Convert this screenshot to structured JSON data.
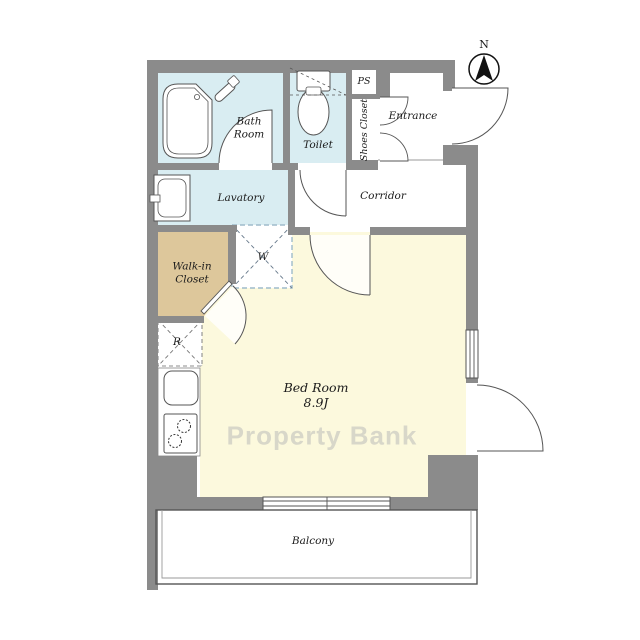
{
  "plan": {
    "compass_label": "N",
    "watermark": "Property Bank"
  },
  "rooms": {
    "bath": {
      "line1": "Bath",
      "line2": "Room"
    },
    "toilet": {
      "label": "Toilet"
    },
    "ps": {
      "label": "PS"
    },
    "shoes_closet": {
      "label": "Shoes Closet"
    },
    "entrance": {
      "label": "Entrance"
    },
    "corridor": {
      "label": "Corridor"
    },
    "lavatory": {
      "label": "Lavatory"
    },
    "walkin_closet": {
      "line1": "Walk-in",
      "line2": "Closet"
    },
    "washer": {
      "label": "W"
    },
    "refrigerator": {
      "label": "R"
    },
    "bedroom": {
      "label": "Bed Room",
      "size": "8.9J"
    },
    "balcony": {
      "label": "Balcony"
    }
  },
  "colors": {
    "wall": "#8b8b8b",
    "wet": "#d9edf2",
    "tan": "#ddc79b",
    "cream": "#fcf9dd",
    "line": "#555555",
    "dash": "#9fbccb"
  }
}
